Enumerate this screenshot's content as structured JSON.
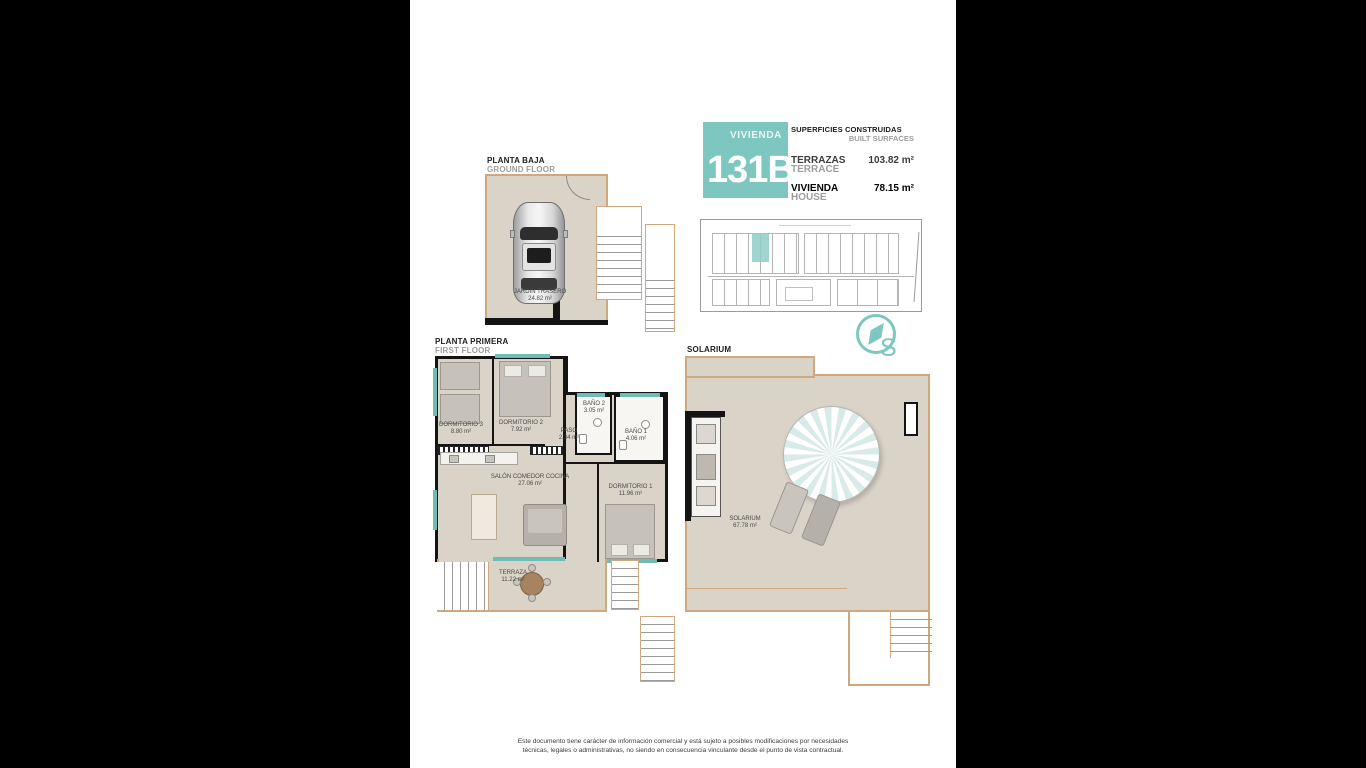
{
  "colors": {
    "accent": "#7ec6c0",
    "plan_floor": "#d9d3c8",
    "plan_outline": "#cfa87d",
    "wall": "#141414",
    "muted_text": "#9d9d9c"
  },
  "title_block": {
    "unit_label": "VIVIENDA",
    "unit_number": "131B",
    "surfaces_title_es": "SUPERFICIES CONSTRUIDAS",
    "surfaces_title_en": "BUILT SURFACES",
    "rows": [
      {
        "es": "TERRAZAS",
        "en": "TERRACE",
        "value": "103.82 m²"
      },
      {
        "es": "VIVIENDA",
        "en": "HOUSE",
        "value": "78.15 m²"
      }
    ]
  },
  "compass": {
    "letter": "S"
  },
  "plans": {
    "ground": {
      "label_es": "PLANTA BAJA",
      "label_en": "GROUND FLOOR",
      "rooms": [
        {
          "name": "JARDIN TRASERO",
          "area": "24.82 m²"
        }
      ]
    },
    "first": {
      "label_es": "PLANTA PRIMERA",
      "label_en": "FIRST FLOOR",
      "rooms": [
        {
          "name": "DORMITORIO 3",
          "area": "8.80 m²"
        },
        {
          "name": "DORMITORIO 2",
          "area": "7.92 m²"
        },
        {
          "name": "PASO",
          "area": "2.34 m²"
        },
        {
          "name": "BAÑO 2",
          "area": "3.05 m²"
        },
        {
          "name": "BAÑO 1",
          "area": "4.06 m²"
        },
        {
          "name": "SALÓN COMEDOR COCINA",
          "area": "27.06 m²"
        },
        {
          "name": "DORMITORIO 1",
          "area": "11.96 m²"
        },
        {
          "name": "TERRAZA",
          "area": "11.22 m²"
        }
      ]
    },
    "solarium": {
      "label": "SOLARIUM",
      "rooms": [
        {
          "name": "SOLARIUM",
          "area": "67.78 m²"
        }
      ]
    }
  },
  "footer": {
    "line1": "Este documento tiene carácter de información comercial y está sujeto a posibles modificaciones por necesidades",
    "line2": "técnicas, legales o administrativas, no siendo en consecuencia vinculante desde el punto de vista contractual."
  }
}
